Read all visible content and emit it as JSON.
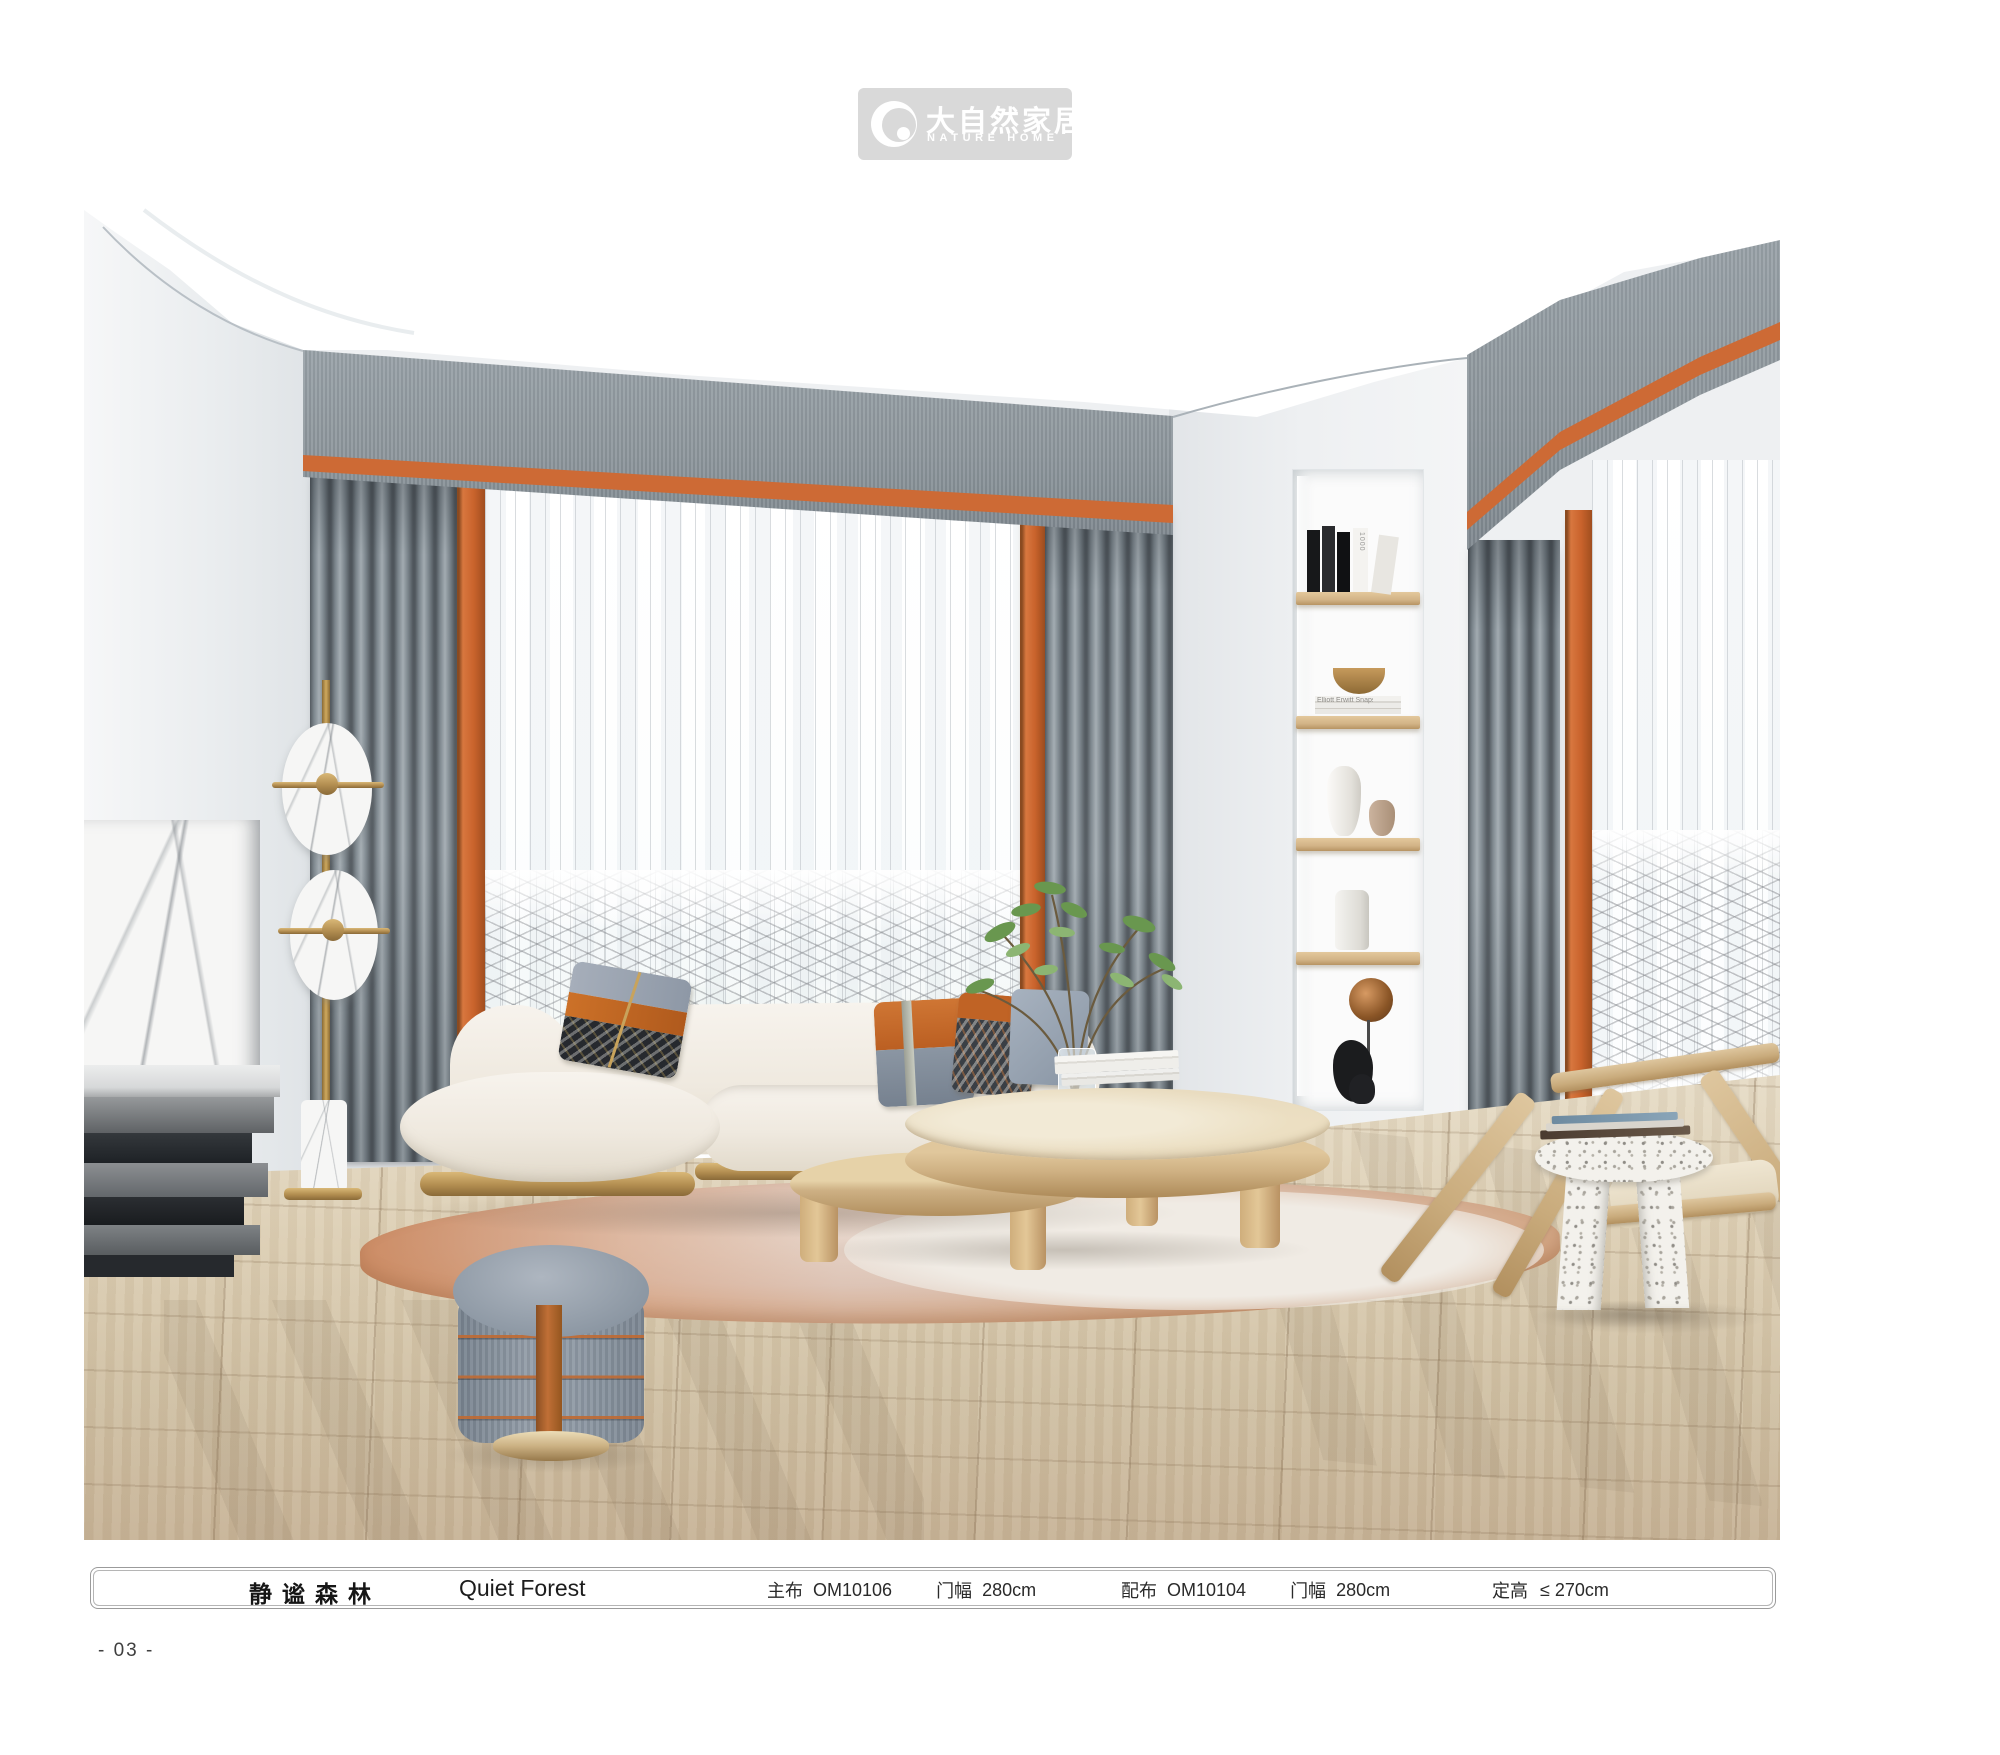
{
  "page": {
    "background": "#ffffff",
    "number": "- 03 -"
  },
  "logo": {
    "name_cn": "大自然家居",
    "name_en": "NATURE HOME",
    "badge_color": "#d9d9d9",
    "icon": "crescent-circle"
  },
  "product_bar": {
    "series_cn": "静谧森林",
    "series_en": "Quiet Forest",
    "main_fabric": {
      "label": "主布",
      "code": "OM10106",
      "width_label": "门幅",
      "width_value": "280cm"
    },
    "companion_fabric": {
      "label": "配布",
      "code": "OM10104",
      "width_label": "门幅",
      "width_value": "280cm"
    },
    "fixed_height": {
      "label": "定高",
      "value": "≤ 270cm"
    }
  },
  "scene": {
    "description": "Living-room render: gray linen valances with orange stripe, gray pleated drapes, orange trim bands, patterned white sheers, wall niche with wood shelves, cream curved sofa with gold base, wood coffee table with plant, gray ottoman with orange straps, marble disc floor lamp, terrazzo side table, wood lounge chair, round orange-cream rug on light wood floor",
    "palette": {
      "accent_orange": "#c9682f",
      "curtain_gray": "#8e979d",
      "wood": "#d7bb8e",
      "gold": "#b28d50",
      "wall": "#eef0f2",
      "floor": "#d8cab0"
    },
    "niche_books": {
      "spine_text_1": "1000",
      "spine_text_2": "Elliott Erwitt Snaps"
    }
  }
}
